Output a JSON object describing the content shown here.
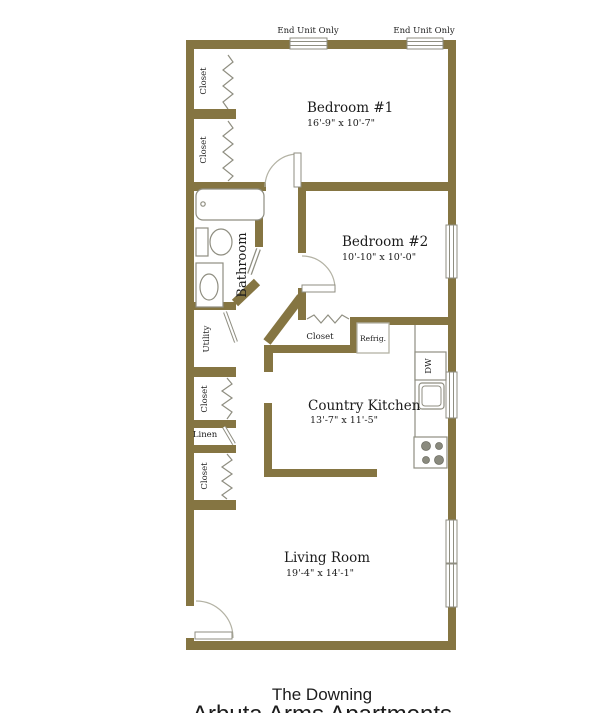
{
  "plan": {
    "bedroom1": {
      "name": "Bedroom #1",
      "dims": "16'-9\" x 10'-7\""
    },
    "bedroom2": {
      "name": "Bedroom #2",
      "dims": "10'-10\" x 10'-0\""
    },
    "kitchen": {
      "name": "Country Kitchen",
      "dims": "13'-7\" x 11'-5\""
    },
    "living_room": {
      "name": "Living Room",
      "dims": "19'-4\" x 14'-1\""
    },
    "bathroom": {
      "name": "Bathroom"
    },
    "closet_label": "Closet",
    "utility_label": "Utility",
    "linen_label": "Linen",
    "refrigerator_label": "Refrig.",
    "dishwasher_label": "DW",
    "end_unit_note": "End Unit Only"
  },
  "title_block": {
    "plan_name": "The Downing",
    "property_name": "Arbuta Arms Apartments"
  },
  "colors": {
    "wall": "#857542",
    "fixture_line": "#8f8e81",
    "door_arc": "#b3b2a4",
    "text": "#1c1c1c",
    "background": "#ffffff"
  }
}
